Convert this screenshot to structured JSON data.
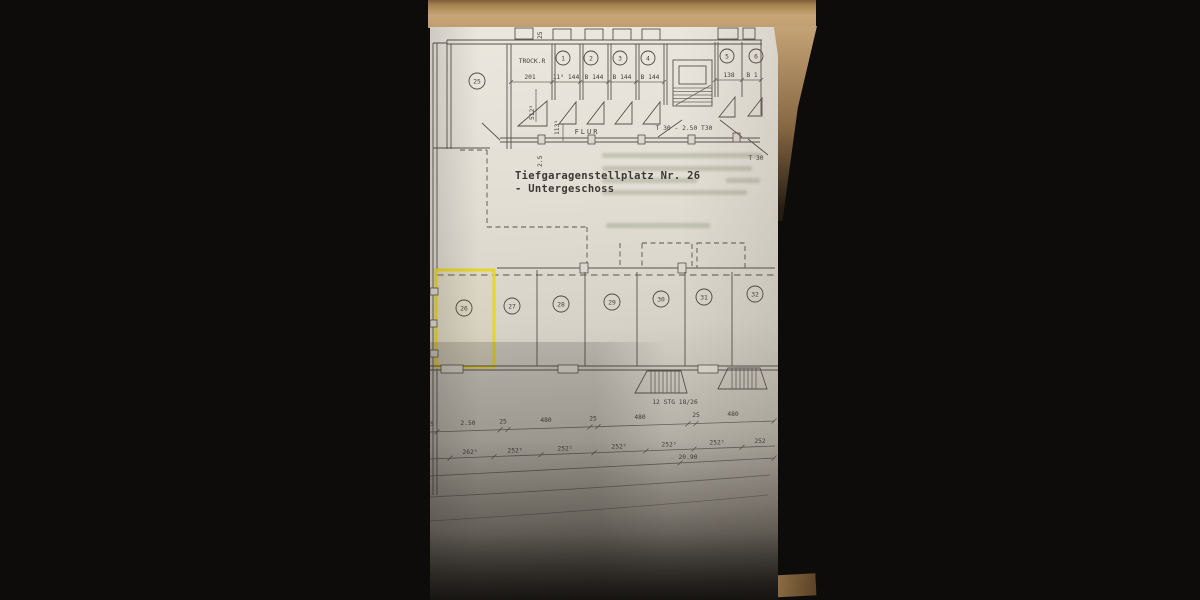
{
  "plan": {
    "title_line1": "Tiefgaragenstellplatz Nr. 26",
    "title_line2": "- Untergeschoss",
    "trock_room_label": "TROCK.R",
    "flur_label": "FLUR",
    "corridor_door_label": "T 30 - 2.50  T30",
    "corridor_door_label_right": "T 30",
    "left_room_number": "25",
    "room_numbers": [
      "1",
      "2",
      "3",
      "4",
      "5",
      "6"
    ],
    "top_dims": {
      "trock_width": "201",
      "cell1": "11⁵ 144",
      "cell2": "B 144",
      "cell3": "B 144",
      "cell4": "B 144",
      "right1": "138",
      "right2": "B 1"
    },
    "vertical_dims": {
      "top": "25",
      "trock_depth": "512⁵",
      "corridor": "113⁵",
      "wall": "2.5"
    },
    "stalls": {
      "numbers": [
        "26",
        "27",
        "28",
        "29",
        "30",
        "31",
        "32"
      ],
      "highlighted_stall": "26",
      "highlight_color": "#e8d42a"
    },
    "stairs_label": "12 STG 18/26",
    "dim_chain_upper": [
      "5",
      "2.50",
      "25",
      "480",
      "25",
      "480",
      "25",
      "480"
    ],
    "dim_chain_lower": [
      "262⁵",
      "252⁵",
      "252⁵",
      "252⁵",
      "252⁵",
      "252⁵",
      "252"
    ],
    "total_length": "20.90"
  }
}
